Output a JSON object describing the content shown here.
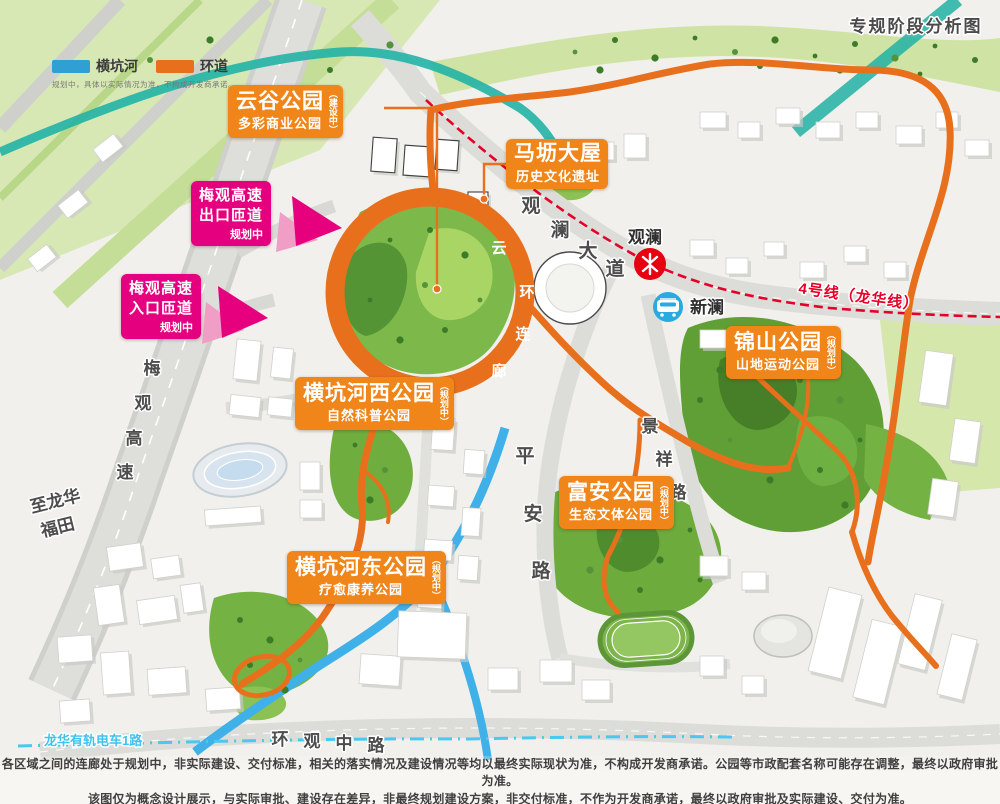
{
  "map_title": "专规阶段分析图",
  "legend": {
    "items": [
      {
        "label": "横坑河",
        "color_key": "river_blue_legend"
      },
      {
        "label": "环道",
        "color_key": "corridor_orange"
      }
    ],
    "note": "规划中，具体以实际情况为准，不构成开发商承诺。"
  },
  "park_labels": [
    {
      "name": "云谷公园",
      "subtitle": "多彩商业公园",
      "status": "（建设中）"
    },
    {
      "name": "马坜大屋",
      "subtitle": "历史文化遗址",
      "status": ""
    },
    {
      "name": "横坑河西公园",
      "subtitle": "自然科普公园",
      "status": "（规划中）"
    },
    {
      "name": "横坑河东公园",
      "subtitle": "疗愈康养公园",
      "status": "（规划中）"
    },
    {
      "name": "富安公园",
      "subtitle": "生态文体公园",
      "status": "（规划中）"
    },
    {
      "name": "锦山公园",
      "subtitle": "山地运动公园",
      "status": "（规划中）"
    }
  ],
  "ramp_labels": [
    {
      "line1": "梅观高速",
      "line2": "出口匝道",
      "status": "规划中"
    },
    {
      "line1": "梅观高速",
      "line2": "入口匝道",
      "status": "规划中"
    }
  ],
  "stations": [
    {
      "name": "观澜",
      "type": "metro"
    },
    {
      "name": "新澜",
      "type": "tram"
    }
  ],
  "roads": {
    "guanlan_avenue": [
      "观",
      "澜",
      "大",
      "道"
    ],
    "pingan_road": [
      "平",
      "安",
      "路"
    ],
    "jingxiang_road": [
      "景",
      "祥",
      "路"
    ],
    "huanguan_road": [
      "环",
      "观",
      "中",
      "路"
    ],
    "meiguan_expressway": [
      "梅",
      "观",
      "高",
      "速"
    ],
    "to_longhua_line1": "至龙华",
    "to_longhua_line2": "福田",
    "tram_line": "龙华有轨电车1路",
    "metro_line4": "4号线（龙华线）"
  },
  "ring_corridor": [
    "云",
    "环",
    "连",
    "廊"
  ],
  "footer": {
    "line1": "各区域之间的连廊处于规划中，非实际建设、交付标准，相关的落实情况及建设情况等均以最终实际现状为准，不构成开发商承诺。公园等市政配套名称可能存在调整，最终以政府审批为准。",
    "line2": "该图仅为概念设计展示，与实际审批、建设存在差异，非最终规划建设方案，非交付标准，不作为开发商承诺，最终以政府审批及实际建设、交付为准。"
  },
  "colors": {
    "corridor_orange": "#e8701d",
    "label_orange": "#f08519",
    "ramp_magenta": "#e4007f",
    "river_blue": "#3fb0e8",
    "river_blue_legend": "#2f9fd4",
    "tram_cyan": "#49c8f2",
    "metro_red": "#e60028",
    "park_green": "#6fae3e",
    "teal_stream": "#22b2a6"
  }
}
